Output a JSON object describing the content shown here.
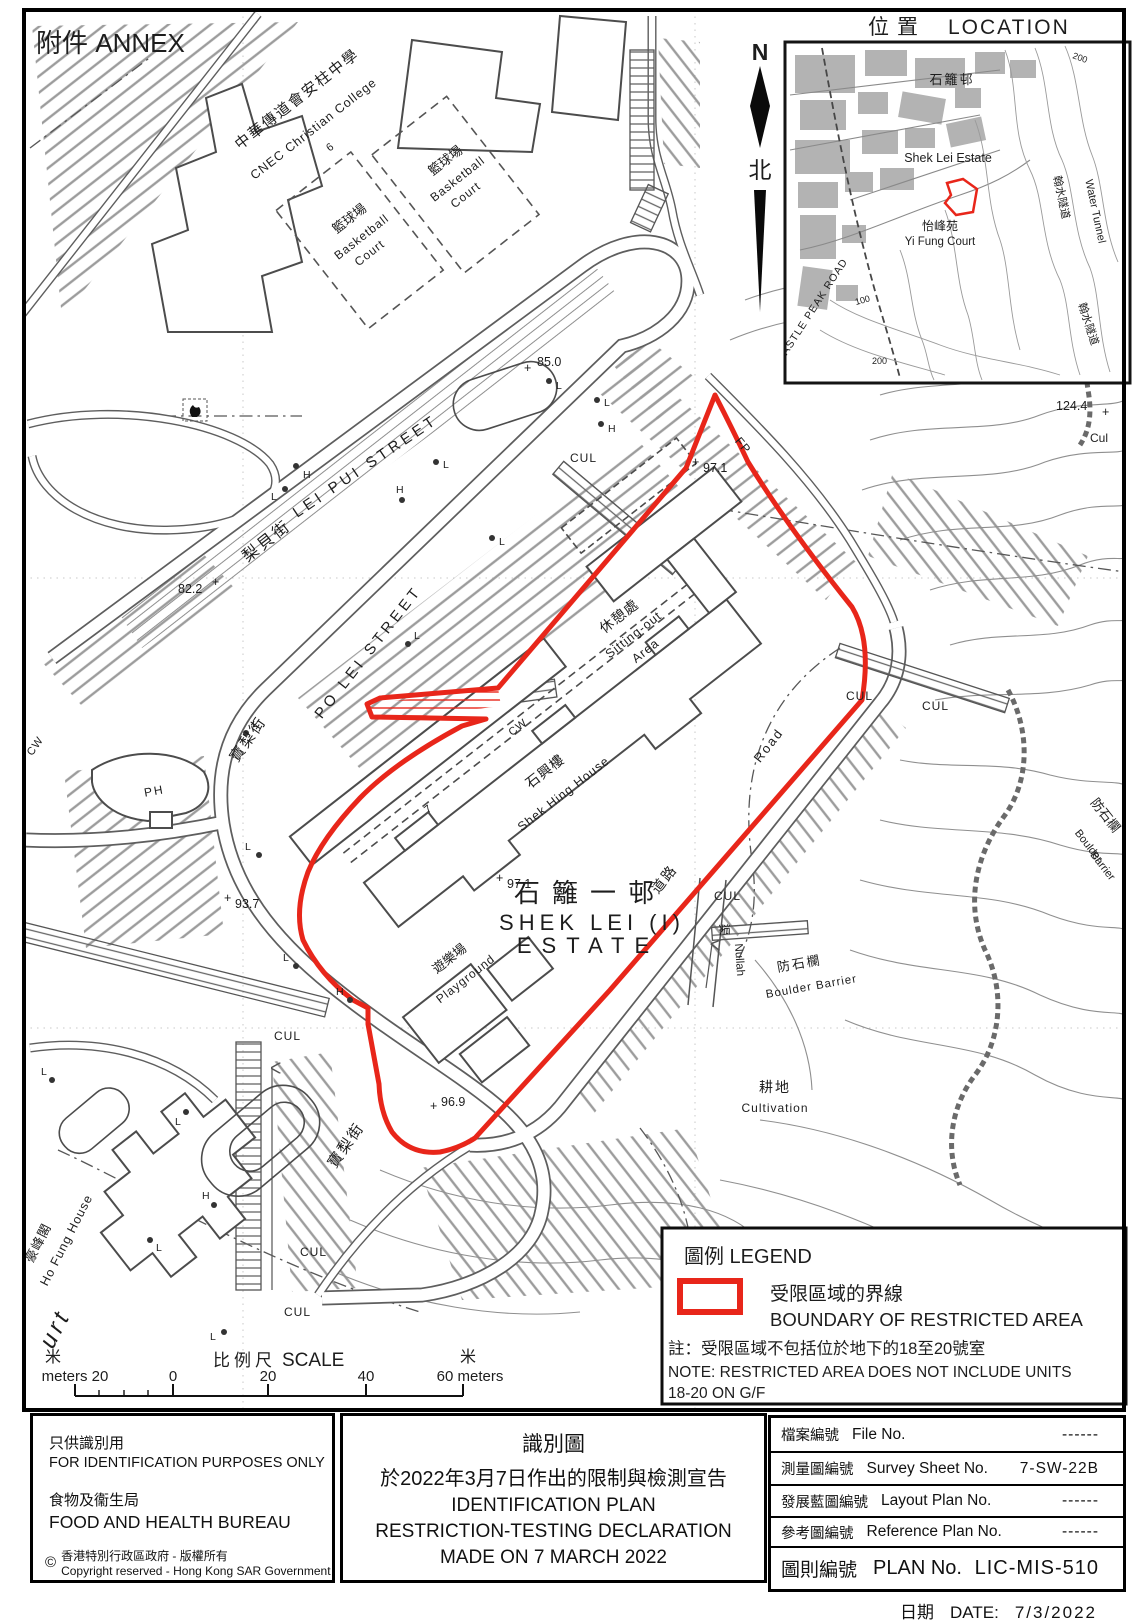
{
  "annex": "附件 ANNEX",
  "inset": {
    "title_zh": "位置",
    "title_en": "LOCATION",
    "north_n": "N",
    "north_zh": "北",
    "shek_lei_zh": "石籬邨",
    "shek_lei_en": "Shek Lei Estate",
    "yi_fung_zh": "怡峰苑",
    "yi_fung_en": "Yi Fung Court",
    "castle_peak_road": "CASTLE PEAK ROAD",
    "water_tunnel_zh": "翰水隧道",
    "water_tunnel_en": "Water Tunnel",
    "contour_200": "200",
    "contour_100": "100"
  },
  "map_labels": {
    "cnec_zh": "中華傳道會安柱中學",
    "cnec_en": "CNEC Christian College",
    "cnec_no": "6",
    "bball_zh": "籃球場",
    "bball_en1": "Basketball",
    "bball_en2": "Court",
    "lei_pui_en": "LEI PUI STREET",
    "lei_pui_zh": "梨貝街",
    "po_lei_en": "PO LEI STREET",
    "po_lei_zh": "寶梨街",
    "sitting_zh": "休憩處",
    "sitting_en1": "Sitting-out",
    "sitting_en2": "Area",
    "shek_hing_zh": "石興樓",
    "shek_hing_en": "Shek Hing House",
    "estate_zh": "石籬一邨",
    "estate_en1": "SHEK LEI (I)",
    "estate_en2": "ESTATE",
    "playground_zh": "遊樂場",
    "playground_en": "Playground",
    "road_zh": "道路",
    "road_en": "Road",
    "nullah_zh": "渠",
    "nullah_en": "Nullah",
    "boulder_zh": "防石欄",
    "boulder_en": "Boulder Barrier",
    "boulder_en1": "Boulder",
    "boulder_en2": "Barrier",
    "cult_zh": "耕地",
    "cult_en": "Cultivation",
    "ho_fung_zh": "豪峰閣",
    "ho_fung_en": "Ho Fung House",
    "urt": "urt",
    "ph": "PH",
    "cw": "CW",
    "fp": "FP",
    "cul": "CUL",
    "cul_cap": "Cul",
    "seven": "7",
    "h": "H",
    "l": "L",
    "plus": "+",
    "spot_85": "85.0",
    "spot_82": "82.2",
    "spot_97": "97.1",
    "spot_93": "93.7",
    "spot_96": "96.9",
    "spot_124": "124.4"
  },
  "legend": {
    "title": "圖例 LEGEND",
    "boundary_zh": "受限區域的界線",
    "boundary_en": "BOUNDARY OF RESTRICTED AREA",
    "note_zh": "註：受限區域不包括位於地下的18至20號室",
    "note_en1": "NOTE: RESTRICTED AREA DOES NOT INCLUDE UNITS",
    "note_en2": "18-20 ON G/F"
  },
  "scale": {
    "label_zh": "比例尺",
    "label_en": "SCALE",
    "m_zh": "米",
    "left": "meters 20",
    "zero": "0",
    "t20": "20",
    "t40": "40",
    "right": "60 meters"
  },
  "footer": {
    "left": {
      "zh1": "只供識別用",
      "en1": "FOR IDENTIFICATION PURPOSES ONLY",
      "zh2": "食物及衞生局",
      "en2": "FOOD AND HEALTH BUREAU",
      "c": "©",
      "c_zh": "香港特別行政區政府 - 版權所有",
      "c_en": "Copyright reserved - Hong Kong SAR Government"
    },
    "title": {
      "zh1": "識別圖",
      "zh2": "於2022年3月7日作出的限制與檢測宣告",
      "en1": "IDENTIFICATION PLAN",
      "en2": "RESTRICTION-TESTING DECLARATION",
      "en3": "MADE ON 7 MARCH 2022"
    },
    "table": {
      "rows": [
        {
          "zh": "檔案編號",
          "en": "File  No.",
          "val": "------"
        },
        {
          "zh": "測量圖編號",
          "en": "Survey  Sheet  No.",
          "val": "7-SW-22B"
        },
        {
          "zh": "發展藍圖編號",
          "en": "Layout  Plan  No.",
          "val": "------"
        },
        {
          "zh": "參考圖編號",
          "en": "Reference  Plan  No.",
          "val": "------"
        },
        {
          "zh": "圖則編號",
          "en": "PLAN  No.",
          "val": "LIC-MIS-510"
        }
      ]
    },
    "date": {
      "zh": "日期",
      "en": "DATE:",
      "value": "7/3/2022"
    }
  }
}
